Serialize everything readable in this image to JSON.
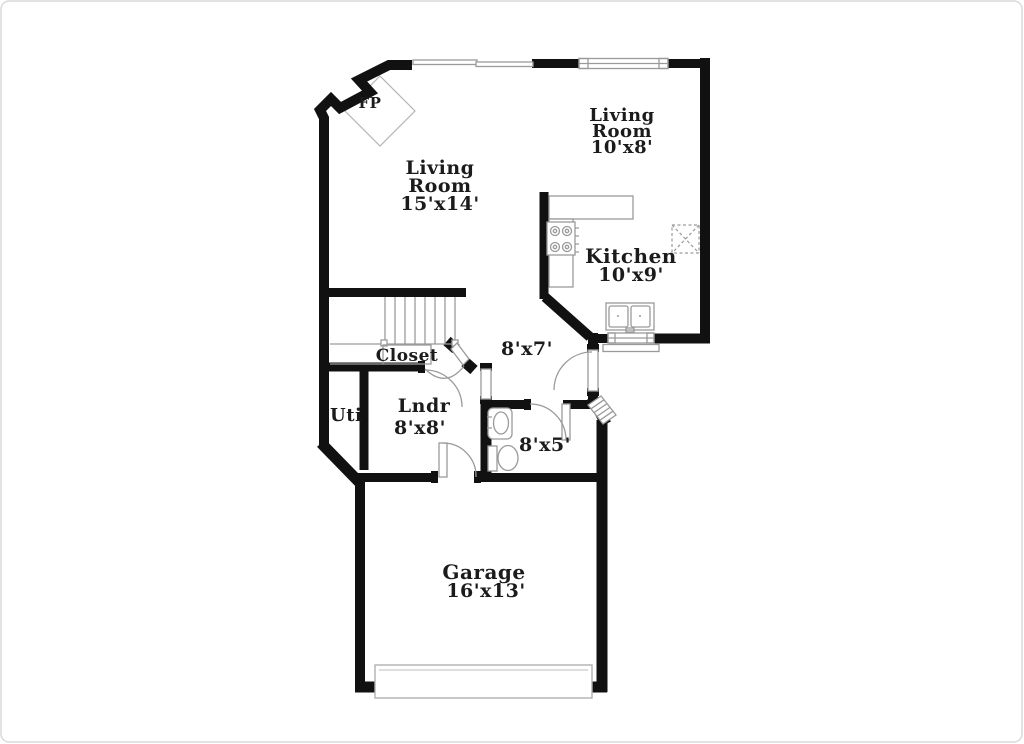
{
  "document_type": "floor-plan",
  "colors": {
    "wall": "#111111",
    "thin_line": "#9a9a9a",
    "text": "#1b1b1b",
    "background": "#ffffff",
    "page_border": "#d9d9d9"
  },
  "floorplan": {
    "fireplace": {
      "label": "FP"
    },
    "living_room_main": {
      "line1": "Living",
      "line2": "Room",
      "dims": "15'x14'"
    },
    "living_room_upper": {
      "line1": "Living",
      "line2": "Room",
      "dims": "10'x8'"
    },
    "kitchen": {
      "name": "Kitchen",
      "dims": "10'x9'"
    },
    "hall": {
      "dims": "8'x7'"
    },
    "closet": {
      "name": "Closet"
    },
    "laundry": {
      "name": "Lndr",
      "dims": "8'x8'"
    },
    "utility": {
      "name": "Uti"
    },
    "bathroom": {
      "dims": "8'x5'"
    },
    "garage": {
      "name": "Garage",
      "dims": "16'x13'"
    }
  }
}
